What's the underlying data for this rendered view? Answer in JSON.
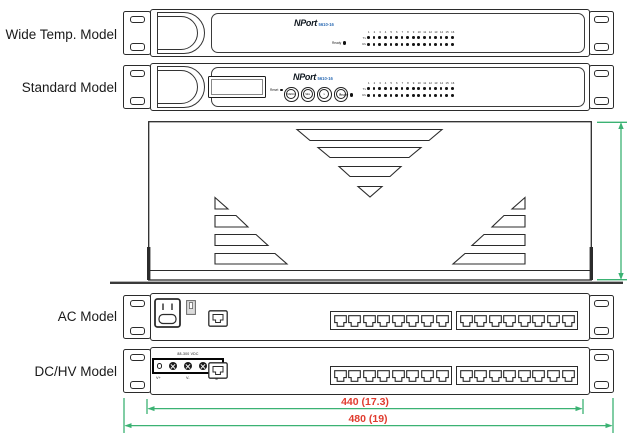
{
  "canvas": {
    "width": 634,
    "height": 440,
    "background": "#ffffff"
  },
  "colors": {
    "line": "#2b2b2b",
    "dimension_line_green": "#3bb273",
    "dimension_text_red": "#e03c2f",
    "brand_model_blue": "#2e6db5"
  },
  "model_labels": {
    "wide_temp": "Wide Temp. Model",
    "standard": "Standard Model",
    "ac": "AC Model",
    "dc_hv": "DC/HV Model"
  },
  "front_panel": {
    "brand": "NPort",
    "model_number": "5610-16",
    "ready_label": "Ready",
    "reset_label": "Reset",
    "led_columns": 16,
    "led_row_labels": [
      "Tx",
      "Rx"
    ],
    "buttons": [
      "MENU",
      "SEL",
      "∨",
      "∧"
    ]
  },
  "rear_panel": {
    "ethernet_ports_per_group": 8,
    "port_groups": 2,
    "dc_terminal_label": "88-300 VDC",
    "dc_terminal_symbols": [
      "V+",
      "V-",
      "⊕"
    ]
  },
  "dimensions": {
    "body_width": "440 (17.3)",
    "overall_width": "480 (19)"
  }
}
